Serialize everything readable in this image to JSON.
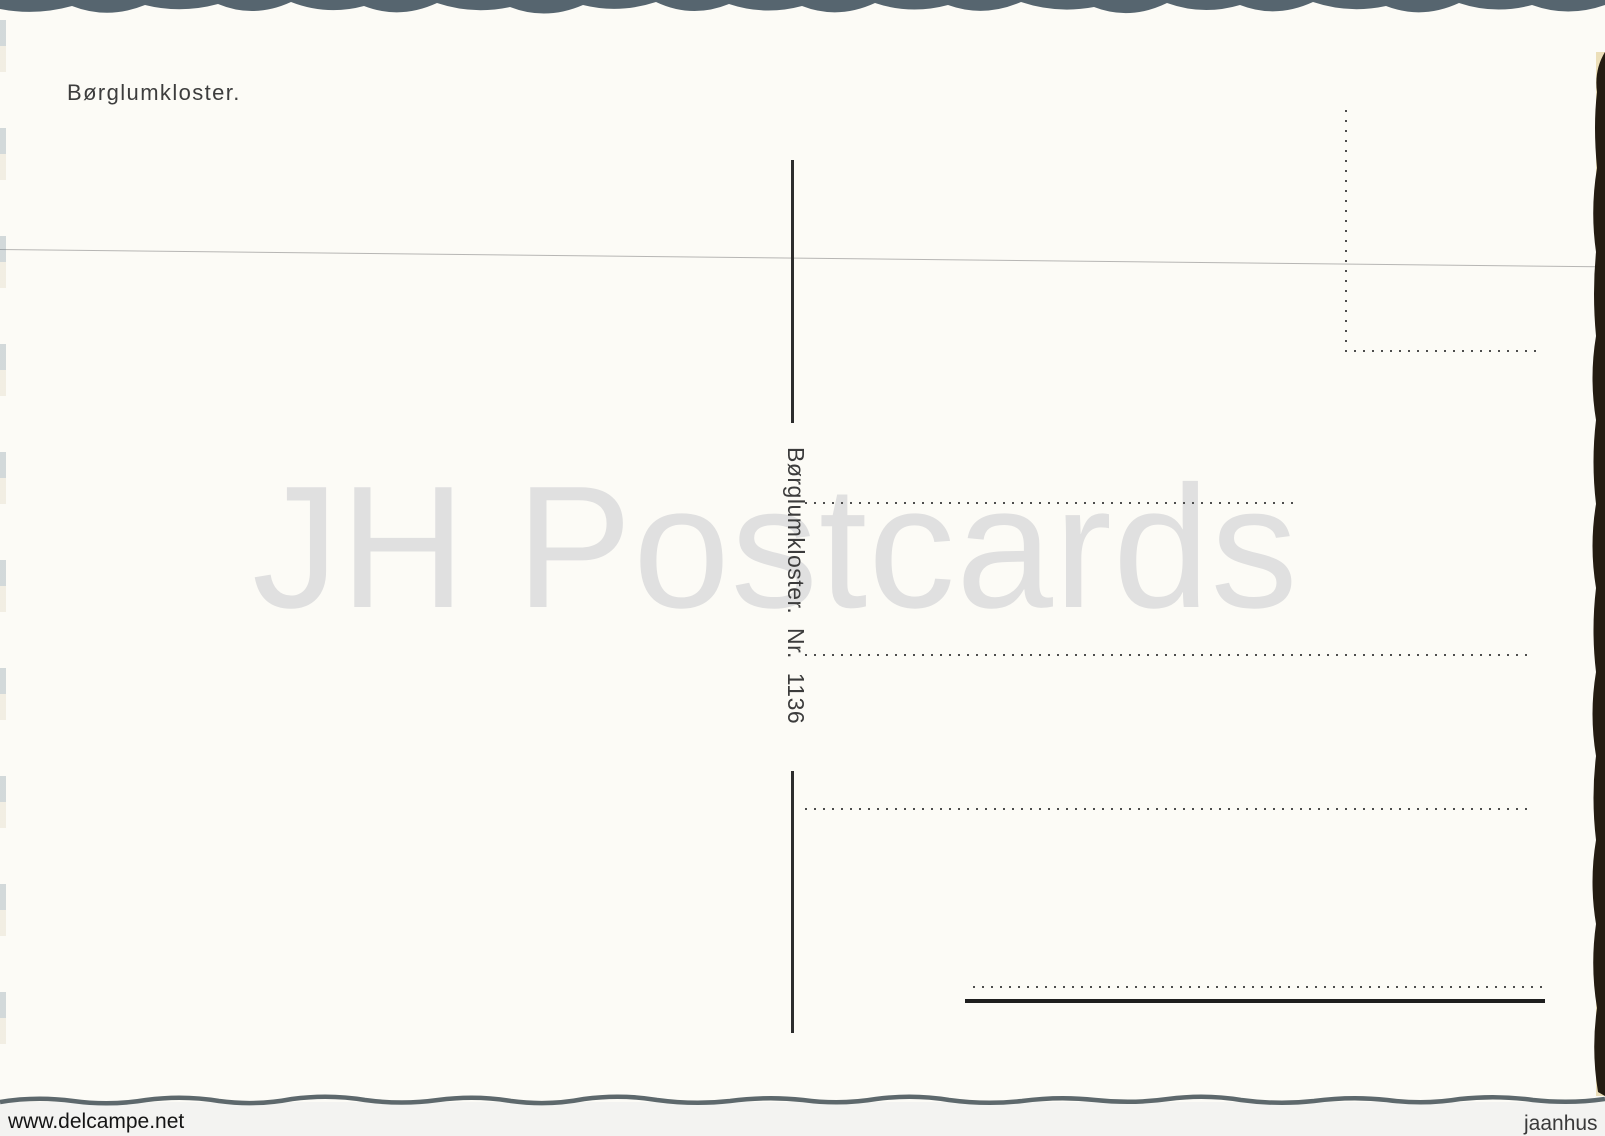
{
  "postcard": {
    "title": "Børglumkloster.",
    "publisher_imprint": "Børglumkloster.  Nr.  1136",
    "watermark": "JH Postcards"
  },
  "scan_margin": {
    "left_watermark": "www.delcampe.net",
    "right_watermark": "jaanhus"
  },
  "icons": {
    "stamp_box": "dotted-stamp-box",
    "address_lines": "dotted-address-lines"
  },
  "colors": {
    "card_background": "#fcfbf6",
    "ink": "#3c3c3c",
    "watermark_gray": "#e0e0e0",
    "deckle_top_edge": "#56656f",
    "deckle_bottom_edge": "#5d686c",
    "deckle_right_edge": "#241c12"
  }
}
